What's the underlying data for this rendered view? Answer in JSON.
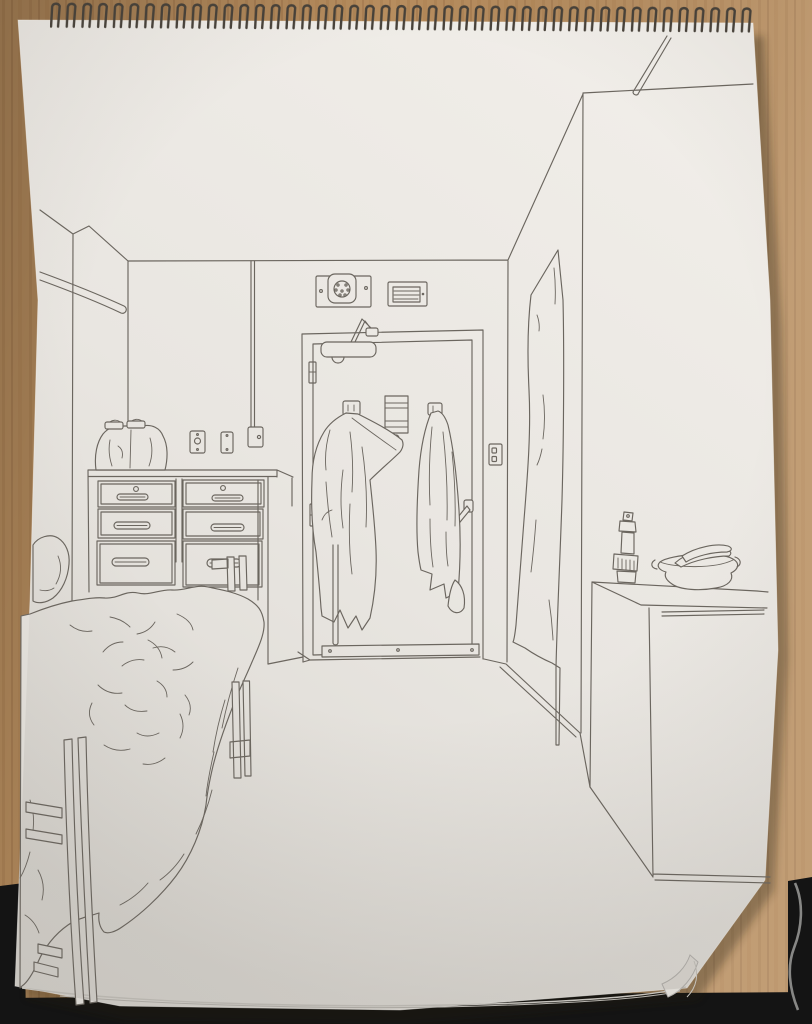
{
  "scene": {
    "type": "photograph",
    "subject": "spiral-bound sketchbook lying on a wooden desk",
    "artwork": "single-line ink perspective drawing of a dorm room interior",
    "drawn_objects": [
      "bed with rumpled blanket and pillow",
      "wood-slat bed posts and side rails",
      "six-drawer dresser with handles and knobs",
      "soft bag on dresser top",
      "light-switch plate and blank wall plate",
      "surface conduit with outlet box",
      "wall pipe with rounded end",
      "entry door with door-closer, hinges, kick plate and lever handle",
      "two robes hanging on door hooks",
      "lined notice and magnet on door",
      "speaker box and louvered vent above door",
      "wall outlet beside door",
      "hanging curtain in right alcove",
      "tall cabinet with countertop",
      "spray bottle on cabinet",
      "bowl with bananas",
      "ceiling pipe near right wall top"
    ]
  },
  "colors": {
    "desk_wood": "#b78d5e",
    "desk_wood_shade": "#8f6a42",
    "desk_wood_light": "#cfa878",
    "black_surface": "#141414",
    "paper": "#e9e6e1",
    "paper_bright": "#f1eee9",
    "paper_shade": "#d7d4ce",
    "paper_edge": "#bab7b1",
    "ink": "#6b665f",
    "binding_wire": "#474139",
    "cable": "#9b9b99",
    "pad_shadow": "#241a10"
  }
}
